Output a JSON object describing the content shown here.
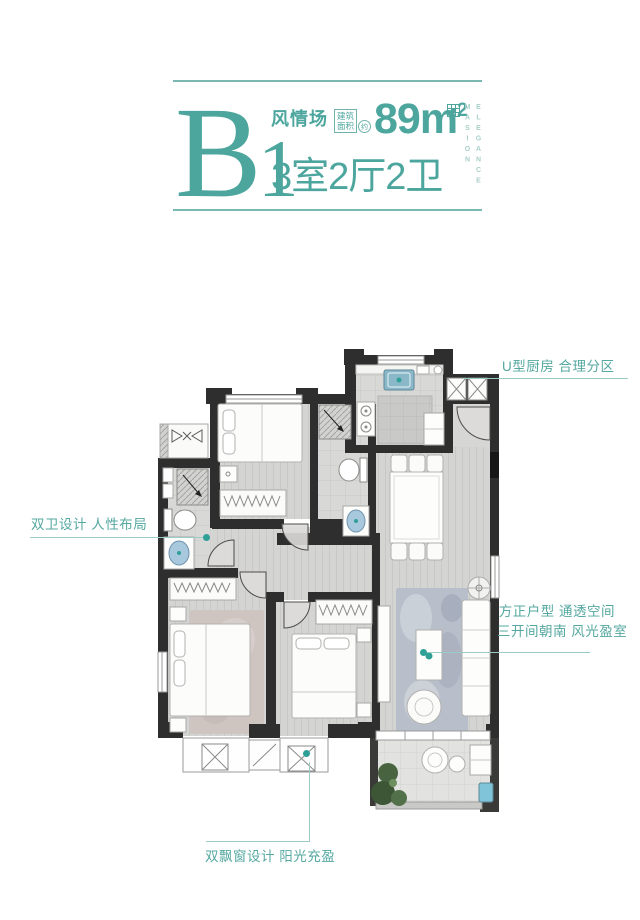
{
  "header": {
    "unit_letter": "B",
    "unit_number": "1",
    "series_name": "风情场",
    "area_badge": {
      "line1": "建筑",
      "line2": "面积",
      "approx": "约"
    },
    "area_value": "89m",
    "area_exponent": "2",
    "layout_text": "3室2厅2卫",
    "brand_vertical": {
      "line1": "ELEGANCE",
      "line2": "MASION"
    }
  },
  "annotations": {
    "kitchen": "U型厨房 合理分区",
    "bathroom": "双卫设计 人性布局",
    "living_line1": "方正户型 通透空间",
    "living_line2": "三开间朝南 风光盈室",
    "bay_window": "双飘窗设计 阳光充盈"
  },
  "colors": {
    "brand_teal": "#4CA69E",
    "light_teal": "#9CCBC5",
    "note_teal": "#55A8A0",
    "vertical_brand_teal": "#A9CFC9",
    "wall_dark": "#2E2E2E",
    "dot_teal": "#2FA096",
    "floor_gray": "#D4D4D2",
    "living_rug": "#B9BFCA",
    "master_rug": "#CEC4C0",
    "plant_green": "#47633F",
    "sink_blue": "#8AB8C9"
  }
}
